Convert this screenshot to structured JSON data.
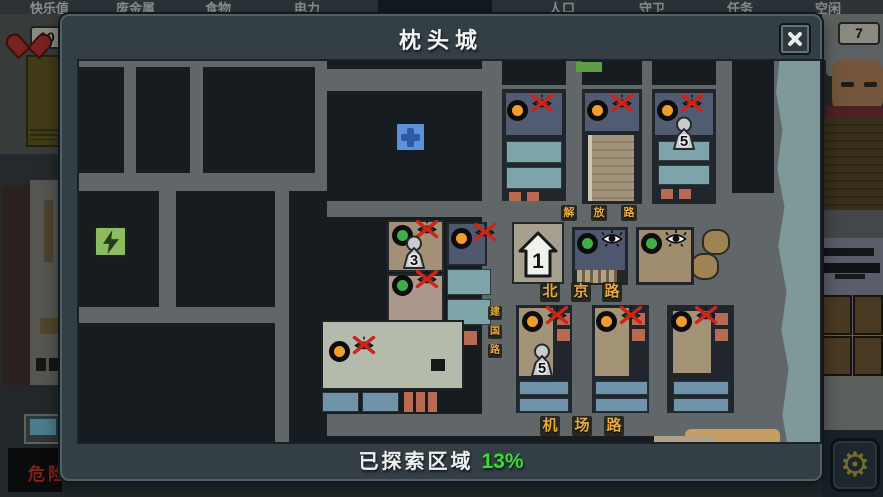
{
  "hud": {
    "top_labels": [
      {
        "text": "快乐值",
        "x": 30
      },
      {
        "text": "废金属",
        "x": 116
      },
      {
        "text": "食物",
        "x": 205
      },
      {
        "text": "电力",
        "x": 294
      },
      {
        "text": "人口",
        "x": 549
      },
      {
        "text": "守卫",
        "x": 639
      },
      {
        "text": "任务",
        "x": 727
      },
      {
        "text": "空闲",
        "x": 815
      }
    ],
    "happiness_value": "10",
    "idle_value": "7",
    "danger_label": "危险"
  },
  "modal": {
    "title": "枕头城",
    "footer_label": "已探索区域",
    "footer_percent": "13%"
  },
  "map": {
    "road_labels": [
      {
        "name": "jiefang-road",
        "chars": [
          "解",
          "放",
          "路"
        ],
        "orientation": "h",
        "x": 482,
        "y": 144,
        "step": 30,
        "tile": 16,
        "font": 11
      },
      {
        "name": "beijing-road",
        "chars": [
          "北",
          "京",
          "路"
        ],
        "orientation": "h",
        "x": 461,
        "y": 221,
        "step": 31,
        "tile": 20,
        "font": 15
      },
      {
        "name": "jichang-road",
        "chars": [
          "机",
          "场",
          "路"
        ],
        "orientation": "h",
        "x": 461,
        "y": 355,
        "step": 32,
        "tile": 20,
        "font": 15
      },
      {
        "name": "jianguo-road",
        "chars": [
          "建",
          "国",
          "路"
        ],
        "orientation": "v",
        "x": 409,
        "y": 245,
        "step": 19,
        "tile": 14,
        "font": 10
      }
    ],
    "markers": [
      {
        "type": "power",
        "x": 15,
        "y": 165
      },
      {
        "type": "hospital",
        "x": 316,
        "y": 61
      },
      {
        "type": "house",
        "x": 439,
        "y": 170,
        "label": "1"
      },
      {
        "type": "dot-orange",
        "x": 428,
        "y": 39
      },
      {
        "type": "eye-crossed",
        "x": 450,
        "y": 31
      },
      {
        "type": "dot-orange",
        "x": 508,
        "y": 39
      },
      {
        "type": "eye-crossed",
        "x": 530,
        "y": 31
      },
      {
        "type": "dot-orange",
        "x": 578,
        "y": 39
      },
      {
        "type": "eye-crossed",
        "x": 600,
        "y": 31
      },
      {
        "type": "pawn",
        "x": 592,
        "y": 55,
        "label": "5"
      },
      {
        "type": "dot-green",
        "x": 313,
        "y": 164
      },
      {
        "type": "eye-crossed",
        "x": 335,
        "y": 157
      },
      {
        "type": "pawn",
        "x": 322,
        "y": 174,
        "label": "3"
      },
      {
        "type": "dot-orange",
        "x": 372,
        "y": 167
      },
      {
        "type": "eye-crossed",
        "x": 393,
        "y": 160
      },
      {
        "type": "dot-green",
        "x": 313,
        "y": 214
      },
      {
        "type": "eye-crossed",
        "x": 335,
        "y": 207
      },
      {
        "type": "dot-green",
        "x": 498,
        "y": 172
      },
      {
        "type": "eye-open",
        "x": 521,
        "y": 168
      },
      {
        "type": "dot-green",
        "x": 562,
        "y": 172
      },
      {
        "type": "eye-open",
        "x": 585,
        "y": 168
      },
      {
        "type": "dot-orange",
        "x": 250,
        "y": 280
      },
      {
        "type": "eye-crossed",
        "x": 272,
        "y": 273
      },
      {
        "type": "dot-orange",
        "x": 443,
        "y": 250
      },
      {
        "type": "eye-crossed",
        "x": 465,
        "y": 243
      },
      {
        "type": "pawn",
        "x": 450,
        "y": 282,
        "label": "5"
      },
      {
        "type": "dot-orange",
        "x": 517,
        "y": 250
      },
      {
        "type": "eye-crossed",
        "x": 539,
        "y": 243
      },
      {
        "type": "dot-orange",
        "x": 592,
        "y": 250
      },
      {
        "type": "eye-crossed",
        "x": 614,
        "y": 243
      }
    ]
  },
  "colors": {
    "explored_percent_green": "#3bdd2e",
    "marker_orange": "#f09d2e",
    "marker_green": "#3fae47",
    "road_label_orange": "#e8a93c",
    "danger_red": "#e03020",
    "river_blue": "#7f999b"
  }
}
